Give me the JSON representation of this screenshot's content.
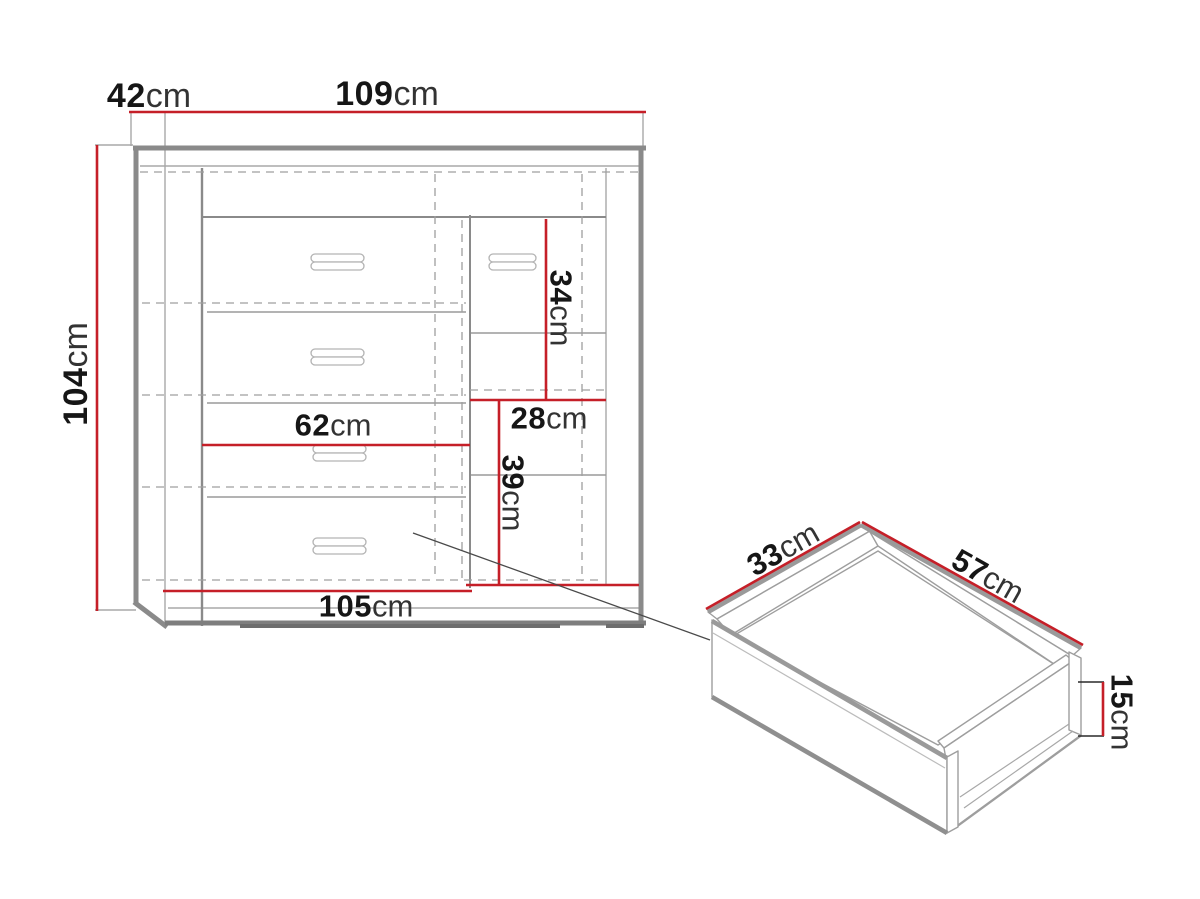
{
  "figure": {
    "type": "furniture dimension diagram",
    "views": {
      "front": "cabinet front view with drawers and shelves",
      "detail": "pulled-out drawer 3d view"
    }
  },
  "colors": {
    "dimension_red": "#c51f28",
    "line_gray": "#9a9a9a",
    "outline_gray": "#8a8a8a",
    "text_black": "#161616",
    "background": "#ffffff"
  },
  "cabinet": {
    "dimensions": {
      "depth": {
        "value": "42",
        "unit": "cm"
      },
      "width": {
        "value": "109",
        "unit": "cm"
      },
      "height": {
        "value": "104",
        "unit": "cm"
      },
      "right_upper_height": {
        "value": "34",
        "unit": "cm"
      },
      "right_inner_width": {
        "value": "28",
        "unit": "cm"
      },
      "right_lower_height": {
        "value": "39",
        "unit": "cm"
      },
      "drawer_front_width": {
        "value": "62",
        "unit": "cm"
      },
      "interior_width": {
        "value": "105",
        "unit": "cm"
      }
    }
  },
  "drawer": {
    "dimensions": {
      "depth": {
        "value": "33",
        "unit": "cm"
      },
      "width": {
        "value": "57",
        "unit": "cm"
      },
      "height": {
        "value": "15",
        "unit": "cm"
      }
    }
  }
}
